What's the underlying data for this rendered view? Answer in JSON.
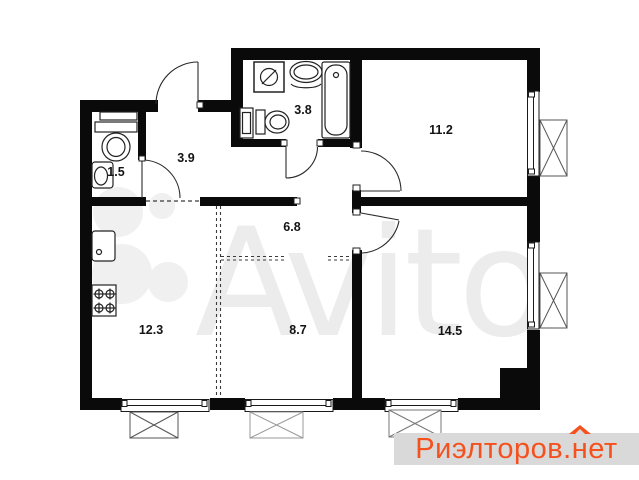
{
  "rooms": {
    "wc": "1.5",
    "hallway": "3.9",
    "bathroom": "3.8",
    "bedroom": "11.2",
    "corridor": "6.8",
    "kitchen": "12.3",
    "living": "8.7",
    "bedroom2": "14.5"
  },
  "watermark": {
    "brand": "Avito"
  },
  "logo": {
    "part1": "Риэлторов.",
    "house_letter": "н",
    "part2": "ет",
    "color": "#f4511e",
    "background": "#d9d9d9"
  },
  "colors": {
    "walls": "#0a0a0a",
    "background": "#ffffff",
    "watermark_gray": "#ececec"
  }
}
